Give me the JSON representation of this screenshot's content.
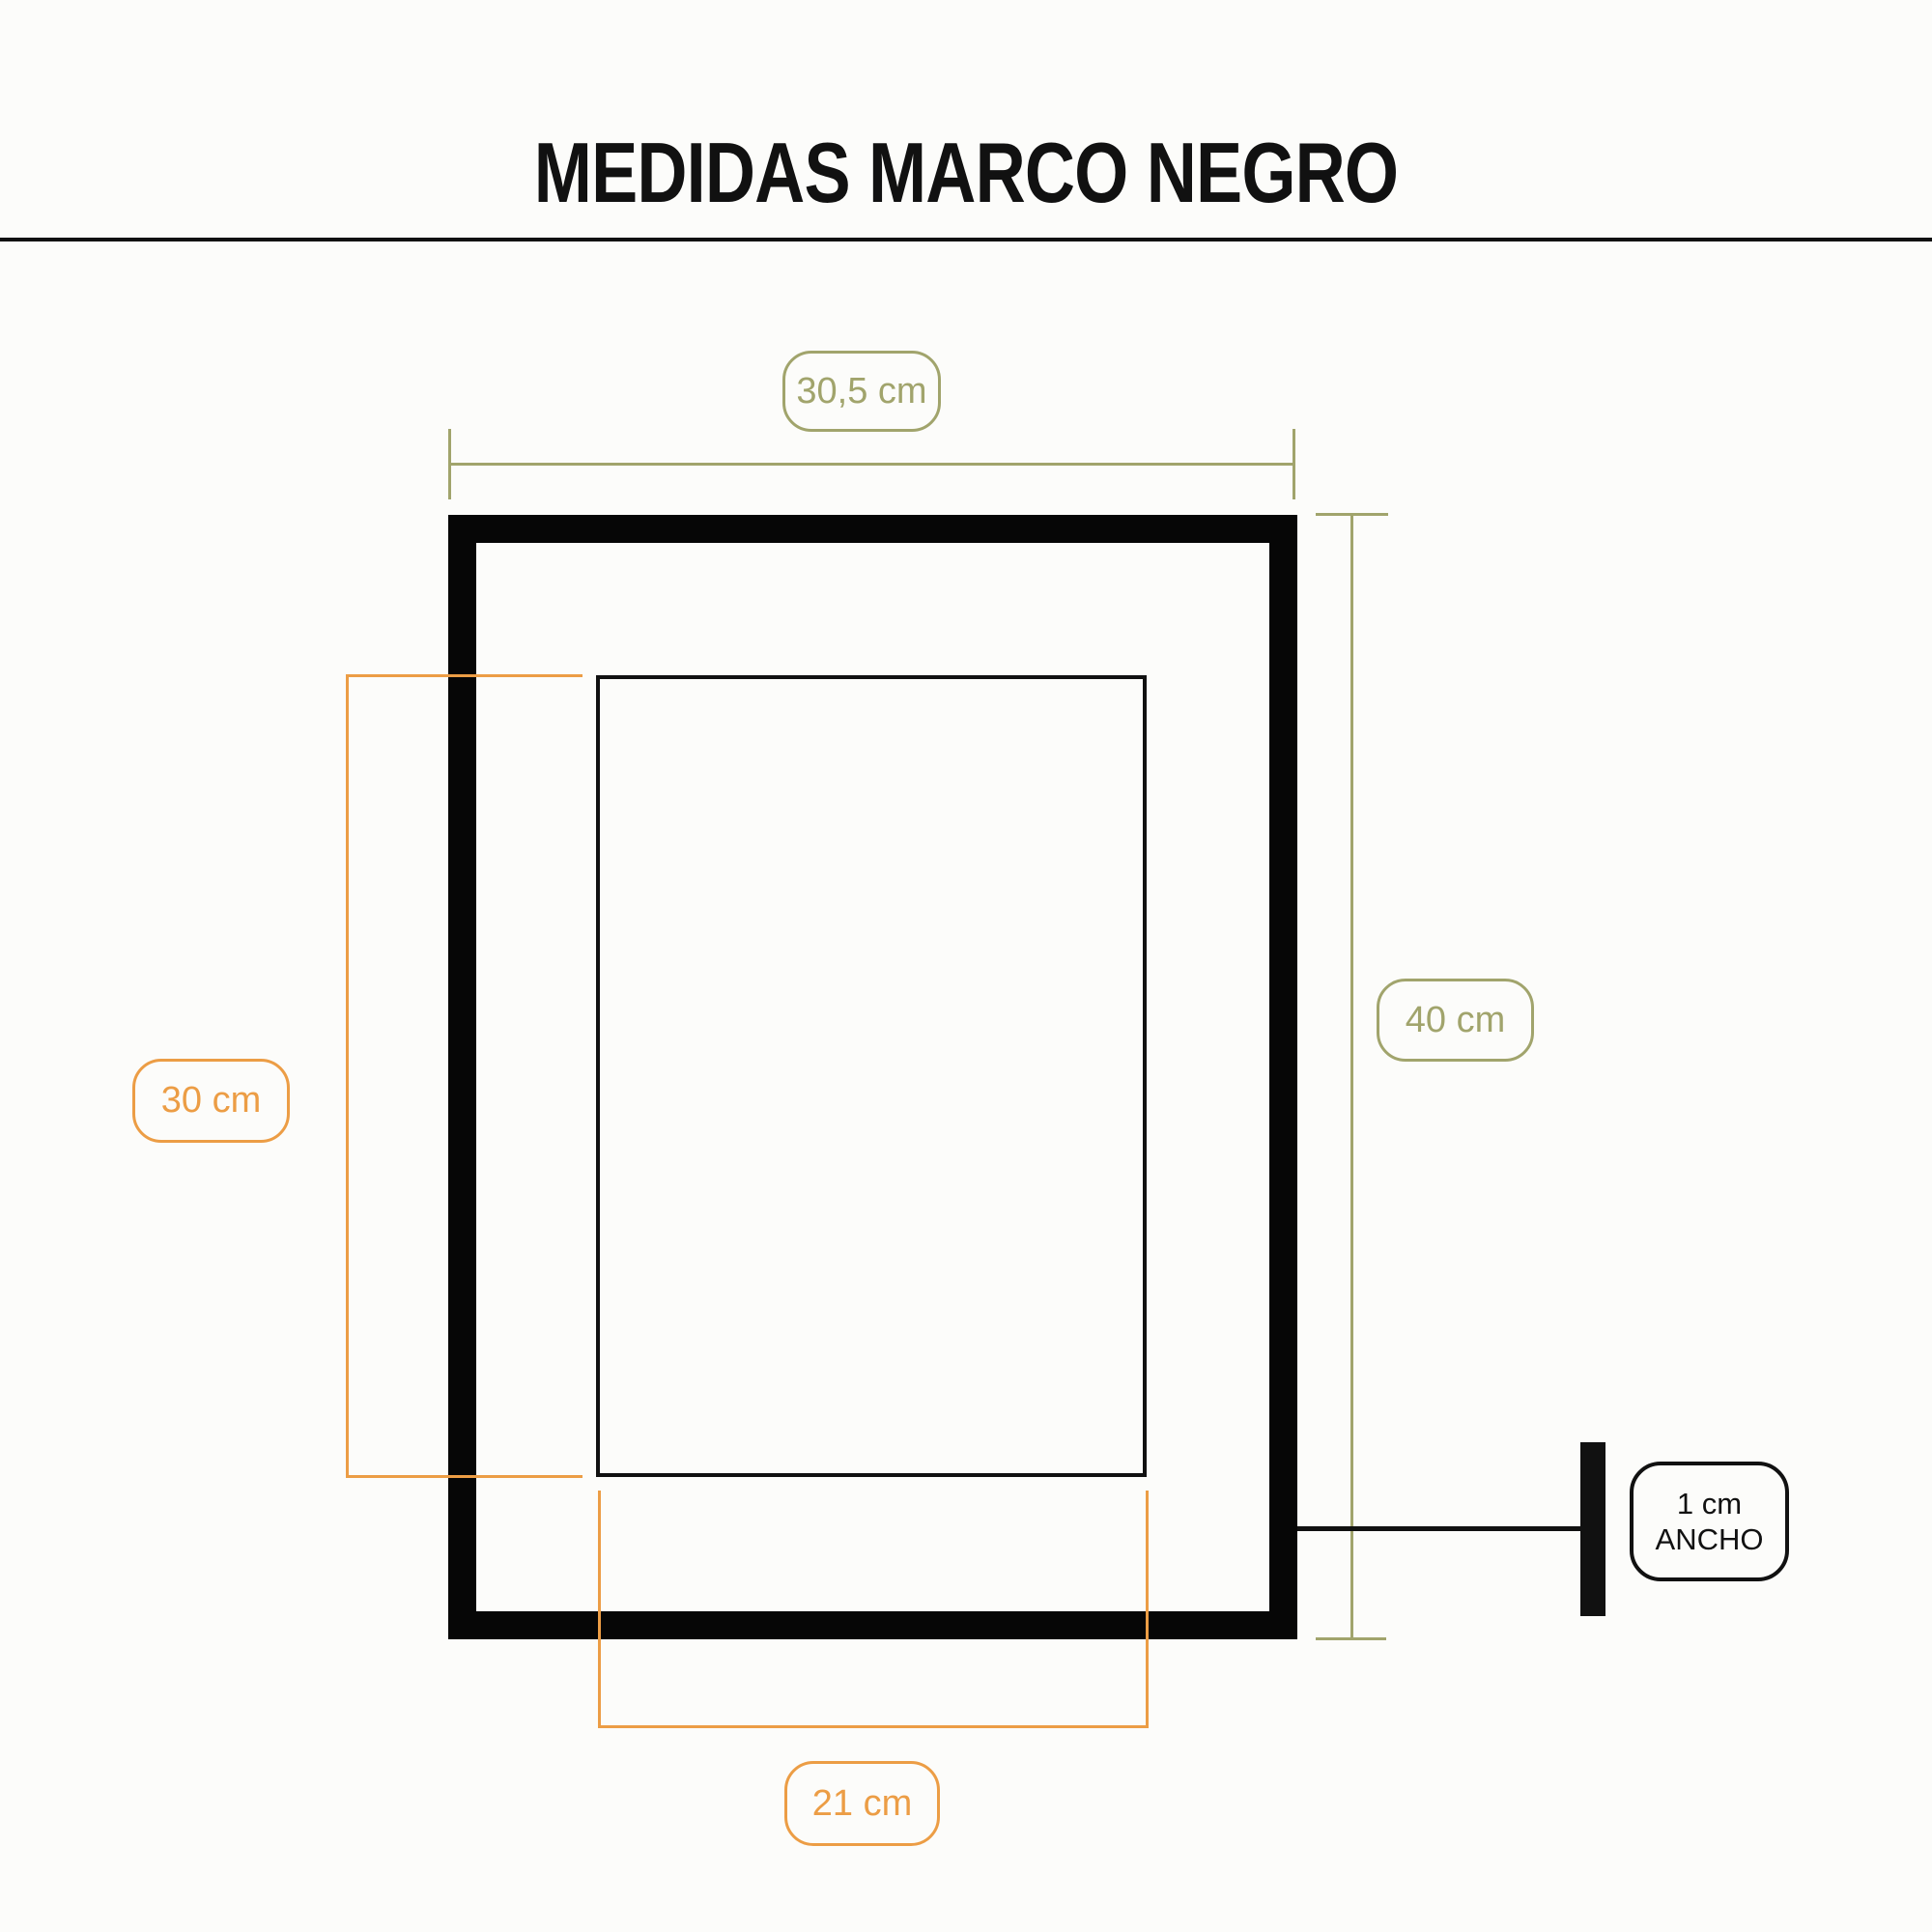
{
  "title": "MEDIDAS MARCO NEGRO",
  "colors": {
    "ink": "#111111",
    "frame_black": "#060606",
    "outer_dimension": "#A1A46C",
    "inner_dimension": "#EC9D45",
    "background": "#FCFCFA"
  },
  "dimensions": {
    "frame_outer_width": {
      "label": "30,5 cm"
    },
    "frame_outer_height": {
      "label": "40 cm"
    },
    "opening_height": {
      "label": "30 cm"
    },
    "opening_width": {
      "label": "21 cm"
    },
    "frame_depth": {
      "value": "1 cm",
      "caption": "ANCHO"
    }
  }
}
